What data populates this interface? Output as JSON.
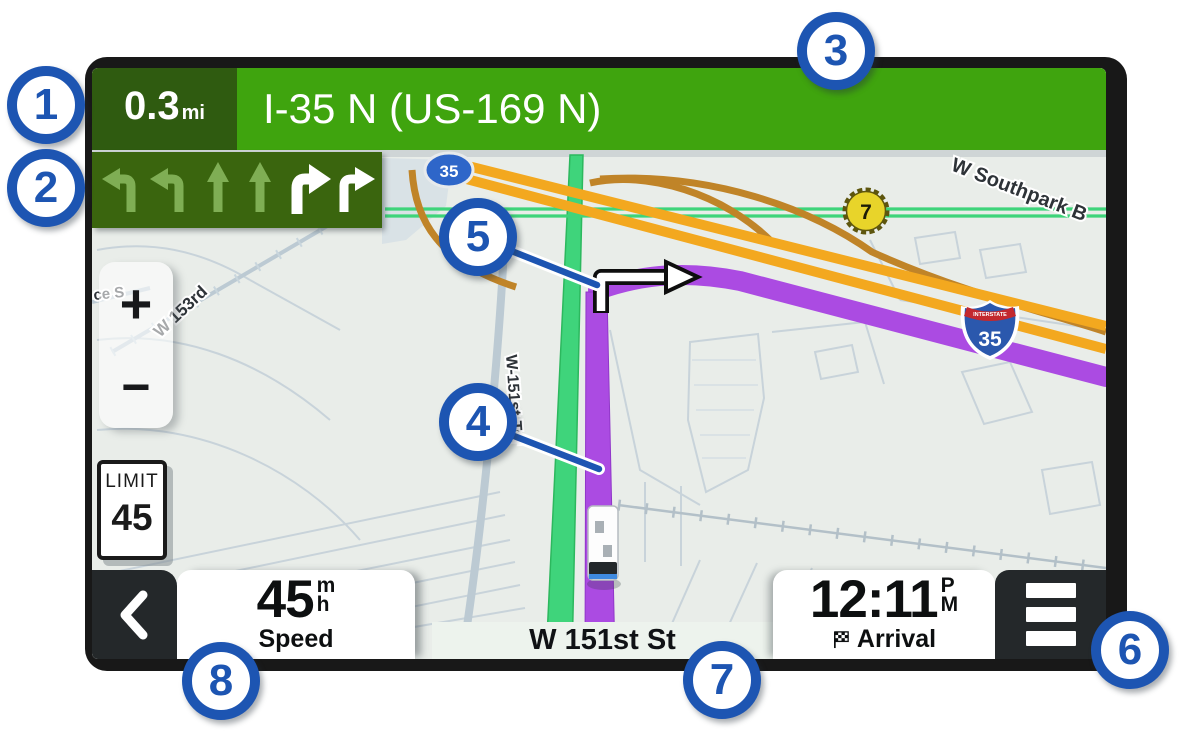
{
  "navigation_bar": {
    "distance_value": "0.3",
    "distance_unit": "mi",
    "instruction": "I-35 N (US-169 N)"
  },
  "lane_guidance": {
    "lanes": [
      {
        "direction": "left",
        "active": false
      },
      {
        "direction": "left",
        "active": false
      },
      {
        "direction": "straight",
        "active": false
      },
      {
        "direction": "straight",
        "active": false
      },
      {
        "direction": "right",
        "active": true
      },
      {
        "direction": "right",
        "active": true
      }
    ]
  },
  "map": {
    "zoom_in_label": "+",
    "zoom_out_label": "−",
    "speed_limit": {
      "title": "LIMIT",
      "value": "45"
    },
    "road_labels": {
      "southpark": "W Southpark B",
      "w153rd": "W 153rd",
      "w151st_ter": "W-151st-Ter",
      "left_edge_partial": "ce S"
    },
    "markers": {
      "state_route_oval": "35",
      "interstate_caption": "INTERSTATE",
      "interstate_number": "35",
      "route_badge": "7"
    }
  },
  "status_bar": {
    "speed": {
      "value": "45",
      "unit_numerator": "m",
      "unit_denominator": "h",
      "label": "Speed"
    },
    "current_street": "W 151st St",
    "arrival": {
      "time": "12:11",
      "meridiem_top": "P",
      "meridiem_bottom": "M",
      "label": "Arrival"
    }
  },
  "callouts": {
    "c1": "1",
    "c2": "2",
    "c3": "3",
    "c4": "4",
    "c5": "5",
    "c6": "6",
    "c7": "7",
    "c8": "8"
  },
  "colors": {
    "guidance_green": "#3fa40e",
    "guidance_dark_green": "#2f5b10",
    "lane_box_green": "#3a650e",
    "route_purple": "#ab4be2",
    "highway_orange": "#f3a81f",
    "road_green": "#3fd47b",
    "callout_blue": "#1d55b2",
    "frame_black": "#181818"
  }
}
